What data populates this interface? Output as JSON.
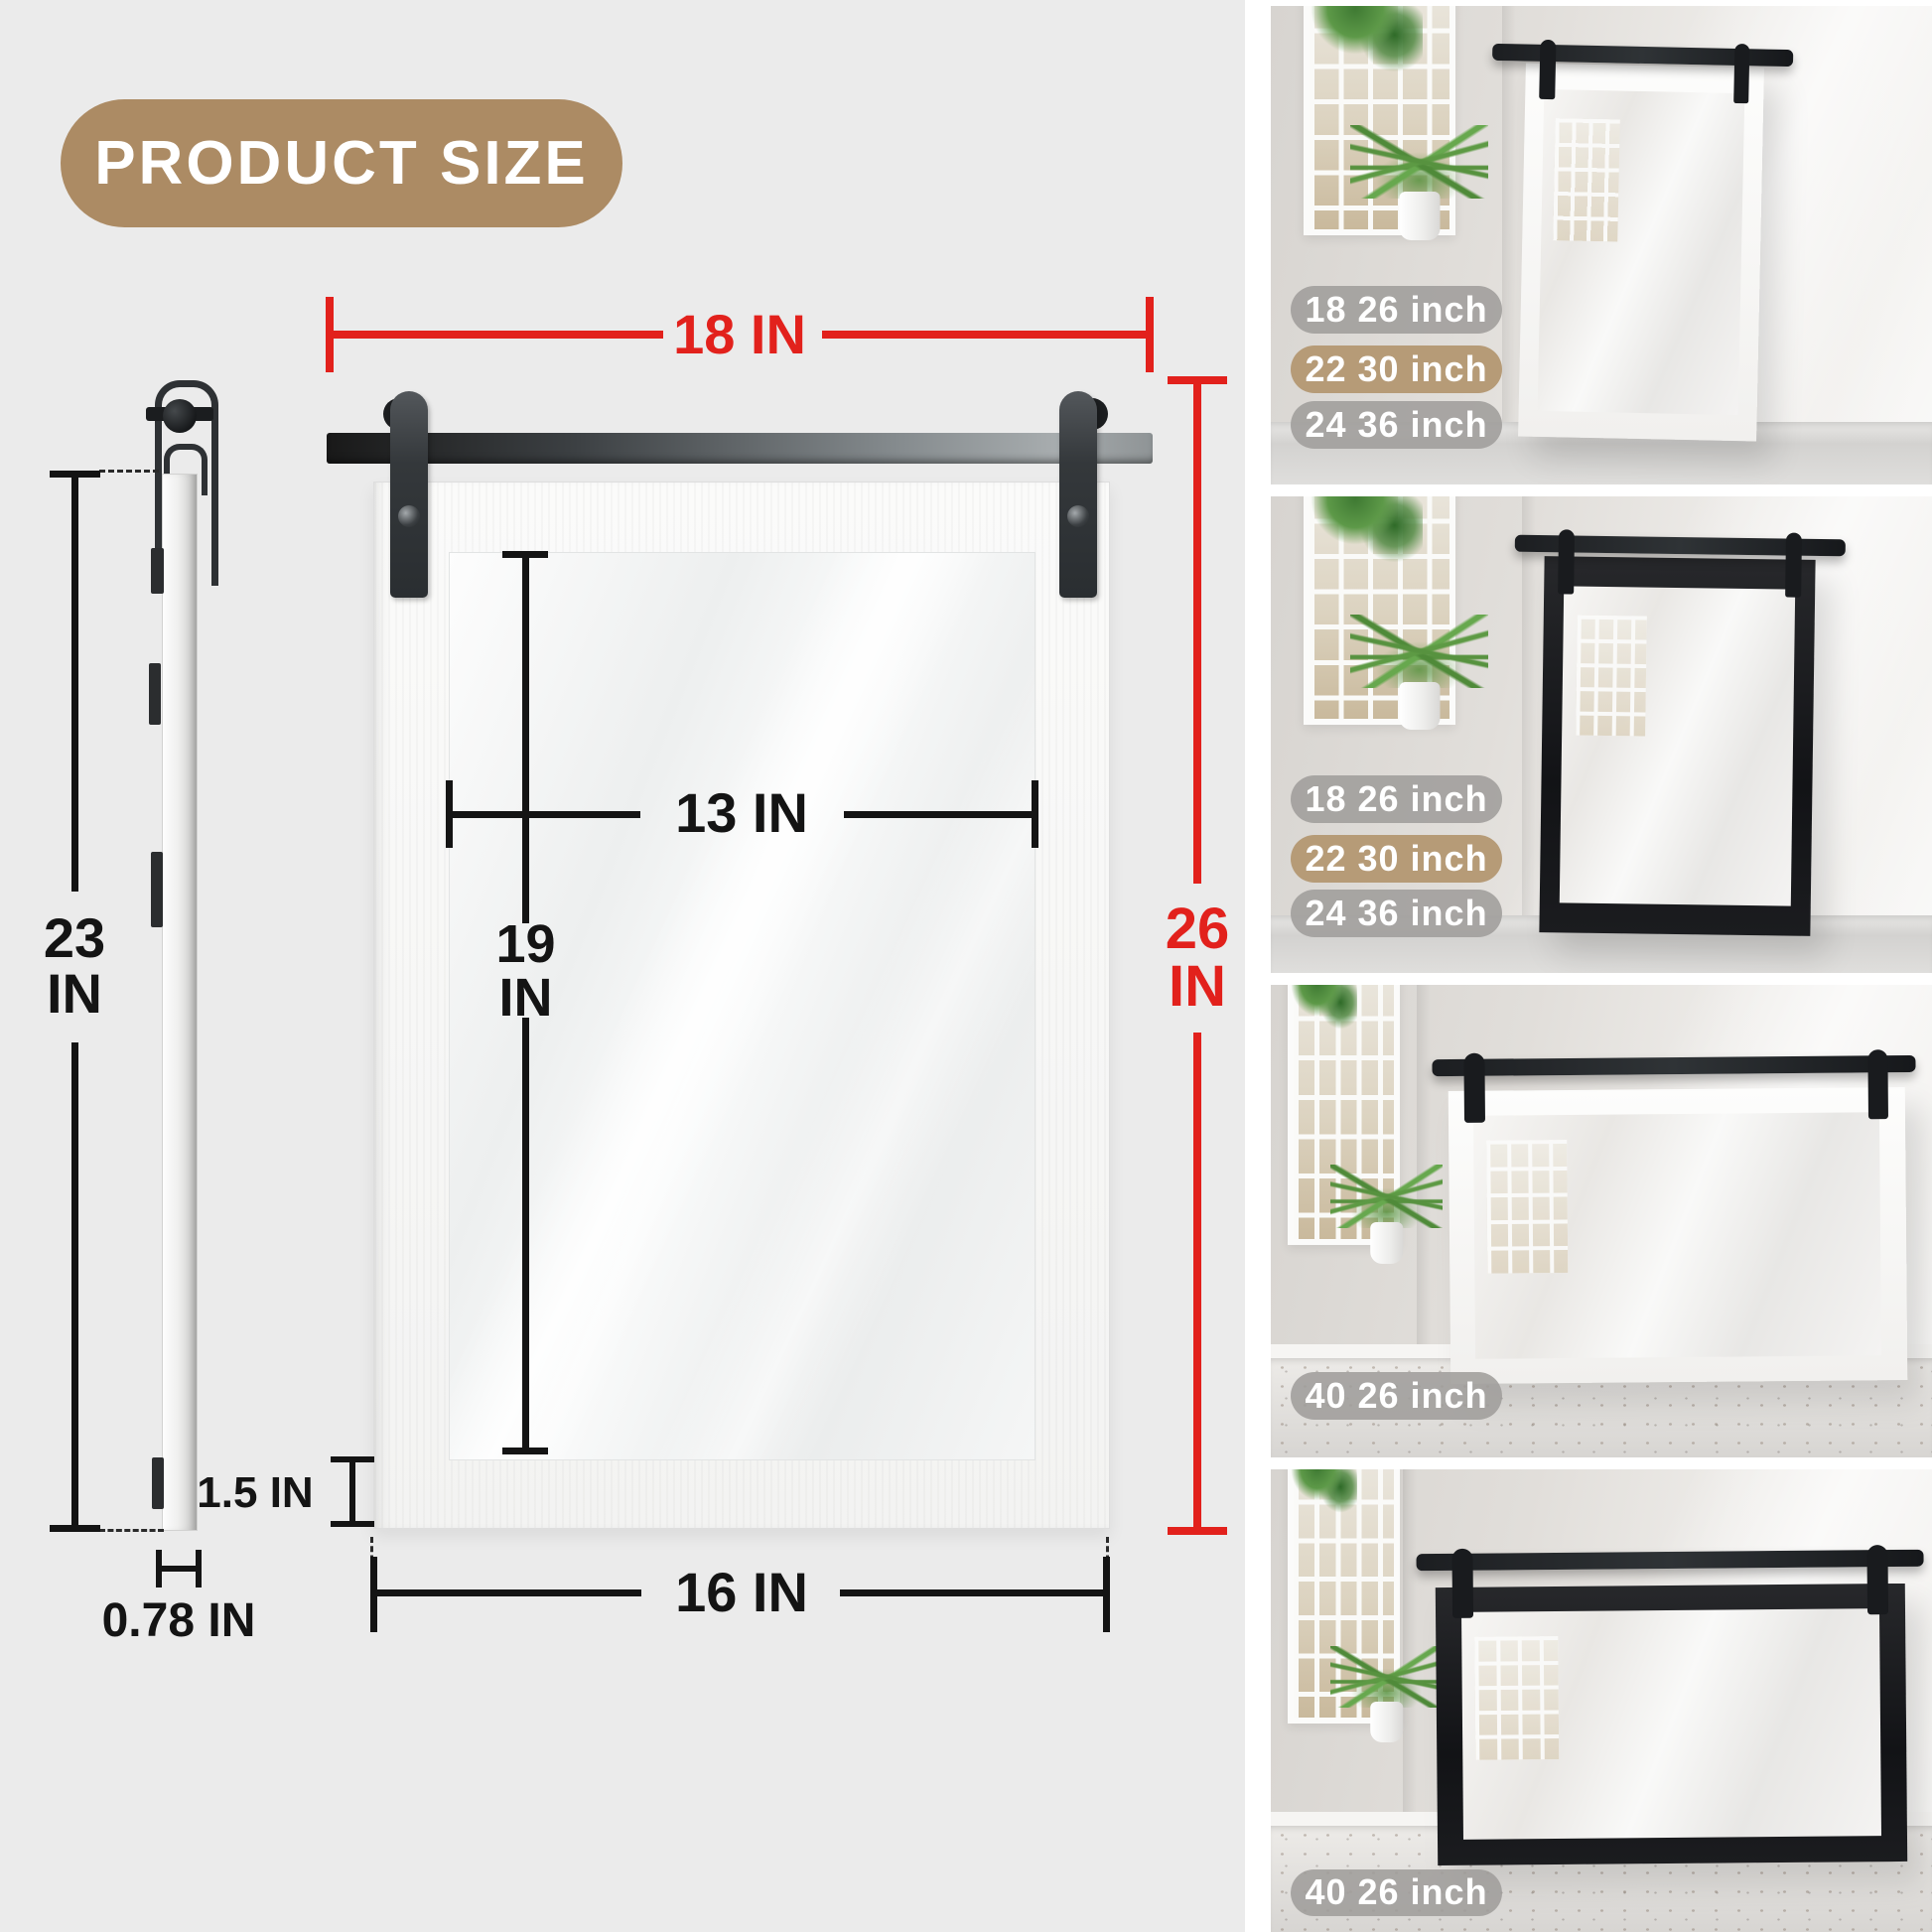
{
  "header": {
    "badge_label": "PRODUCT SIZE"
  },
  "colors": {
    "background": "#ebebeb",
    "accent_red": "#e2211c",
    "line_black": "#141414",
    "title_pill_tan": "#ac8b64",
    "badge_gray": "#9f9d9b",
    "badge_tan": "#b49873"
  },
  "diagram": {
    "front_view": {
      "outer_width_label": "18 IN",
      "outer_height": {
        "value": "26",
        "unit": "IN"
      },
      "glass_width_label": "13 IN",
      "glass_height": {
        "value": "19",
        "unit": "IN"
      },
      "bottom_width_label": "16 IN",
      "frame_thickness_label": "1.5 IN"
    },
    "side_view": {
      "height": {
        "value": "23",
        "unit": "IN"
      },
      "depth_label": "0.78 IN"
    }
  },
  "gallery": {
    "photos": [
      {
        "frame": "white",
        "badges": [
          {
            "label": "18 26 inch",
            "variant": "gray"
          },
          {
            "label": "22 30 inch",
            "variant": "tan"
          },
          {
            "label": "24 36 inch",
            "variant": "gray"
          }
        ]
      },
      {
        "frame": "black",
        "badges": [
          {
            "label": "18 26 inch",
            "variant": "gray"
          },
          {
            "label": "22 30 inch",
            "variant": "tan"
          },
          {
            "label": "24 36 inch",
            "variant": "gray"
          }
        ]
      },
      {
        "frame": "white",
        "badges": [
          {
            "label": "40 26 inch",
            "variant": "gray"
          }
        ]
      },
      {
        "frame": "black",
        "badges": [
          {
            "label": "40 26 inch",
            "variant": "gray"
          }
        ]
      }
    ]
  }
}
